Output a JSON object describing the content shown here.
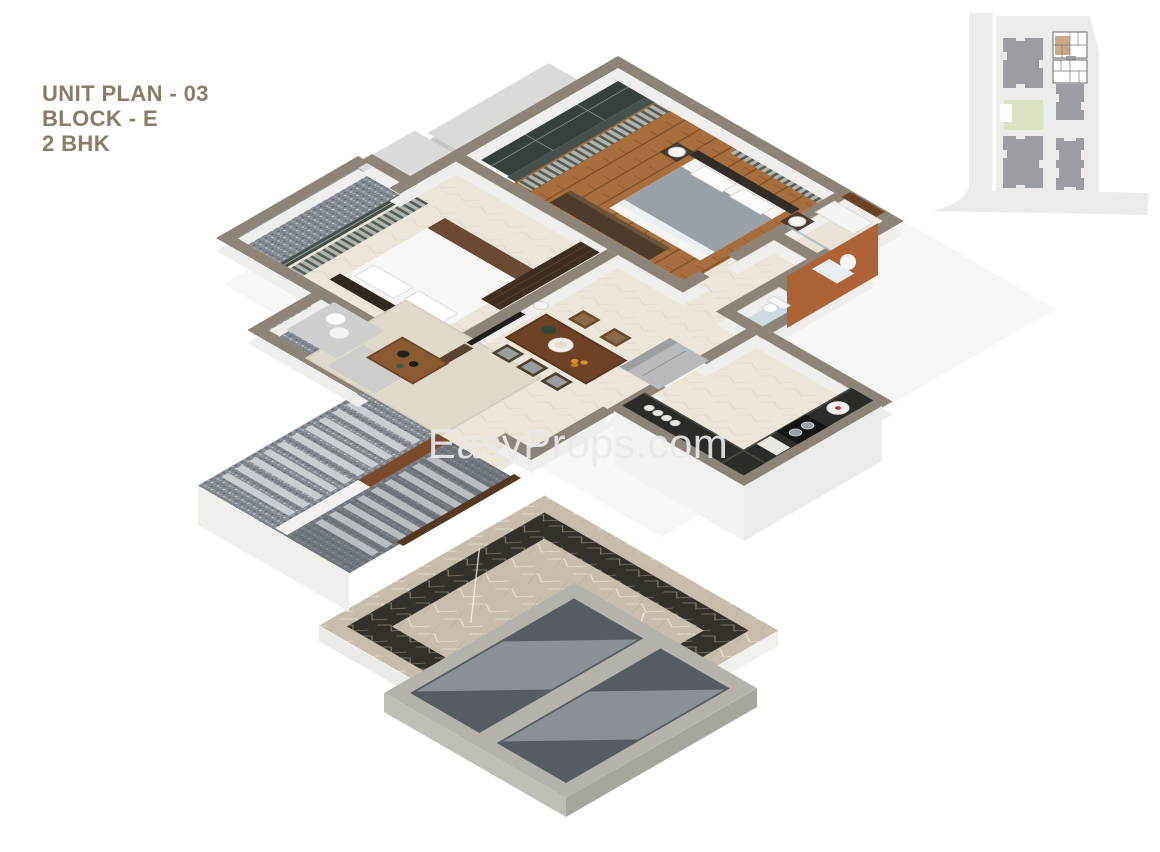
{
  "page": {
    "width": 1160,
    "height": 852
  },
  "title": {
    "lines": [
      "UNIT PLAN - 03",
      "BLOCK - E",
      "2 BHK"
    ]
  },
  "watermark": {
    "text": "EasyProps.com"
  },
  "theme": {
    "pageBg": "#ffffff",
    "titleColor": "#8a7c66",
    "watermarkColor": "#e9e9e9",
    "wallTop": "#8d8377",
    "wallFace": "#efeeec",
    "slab": "#dbdad7",
    "wood": "#a86e3d",
    "woodSeam": "#7d4e26",
    "marble": "#ece5d8",
    "marbleVein": "#ded5c4",
    "graniteBase": "#848a91",
    "graniteDark": "#61666d",
    "stepLight": "#ced1d3",
    "terrace": "#c8bcaa",
    "terraceBorder": "#34302a",
    "terraceVein": "#efe8da",
    "concrete": "#b5b1ab",
    "concreteVoid": "#575c63",
    "ramp": "#8f959b",
    "blueTile": "#ccdbe1",
    "orange": "#ad6336",
    "counter": "#2b2b28",
    "fridge": "#b7babd",
    "sofa": "#cfd0cd",
    "rug": "#e0dacb",
    "tableWood": "#6e4227",
    "chairDark": "#50412f",
    "bedGray": "#9aa0a8",
    "headboard": "#332d28",
    "wardrobe": "#3f2f22",
    "curtainDark": "#565d57",
    "curtainLight": "#aeb3ac",
    "glass": "#36413e",
    "land": "#ecebe9",
    "building": "#9c9ca3",
    "lawn": "#d9e3c3",
    "highlight": "#c9a886"
  }
}
